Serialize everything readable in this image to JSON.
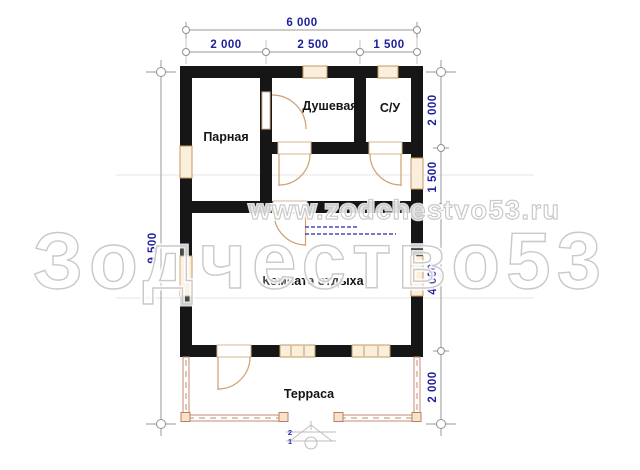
{
  "rooms": {
    "steam_room": "Парная",
    "shower": "Душевая",
    "wc": "С/У",
    "lounge": "Комната отдыха",
    "terrace": "Терраса"
  },
  "dimensions": {
    "top_total": "6 000",
    "top_segments": [
      "2 000",
      "2 500",
      "1 500"
    ],
    "left_total": "9 500",
    "right_segments": [
      "2 000",
      "1 500",
      "4 000",
      "2 000"
    ]
  },
  "steps": {
    "numbers": [
      "2",
      "1"
    ]
  },
  "watermarks": {
    "website": "www.zodchestvo53.ru",
    "brand": "Зодчество53"
  },
  "colors": {
    "wall": "#161616",
    "dimension_text": "#1e1e9e",
    "window_fill": "#faeedd",
    "joinery_outline": "#c49a62",
    "terrace_outline": "#c58a70",
    "watermark_outline": "#c9c9c9",
    "stamp_blue": "#4a4ac0"
  }
}
